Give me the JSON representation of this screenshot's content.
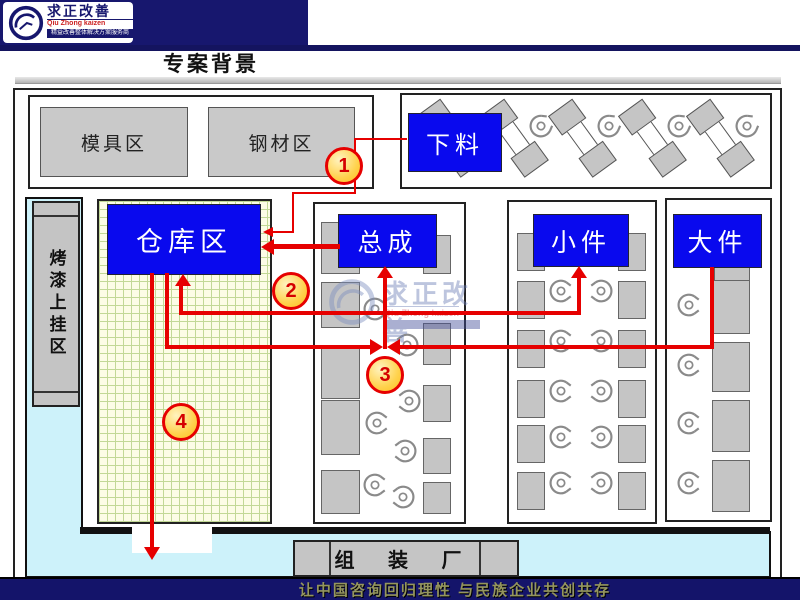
{
  "header": {
    "logo": {
      "title": "求正改善",
      "subtitle": "Qiu Zhong kaizen",
      "tagline": "精益改善整体解决方案服务商"
    },
    "page_title": "专案背景"
  },
  "diagram": {
    "mold_area": "模具区",
    "steel_area": "钢材区",
    "cutting": "下料",
    "warehouse": "仓库区",
    "assembly": "总成",
    "small_parts": "小件",
    "large_parts": "大件",
    "paint_hang_area": "烤漆上挂区",
    "assembly_plant": "组 装 厂",
    "flow_steps": {
      "one": "1",
      "two": "2",
      "three": "3",
      "four": "4"
    }
  },
  "watermark": {
    "title": "求正改善",
    "subtitle": "Qiu Zhong kaizen"
  },
  "footer": {
    "slogan": "让中国咨询回归理性 与民族企业共创共存"
  },
  "colors": {
    "accent_blue": "#0909ee",
    "flow_red": "#e60000",
    "navy": "#17176e",
    "cyan": "#cdf2fa"
  }
}
